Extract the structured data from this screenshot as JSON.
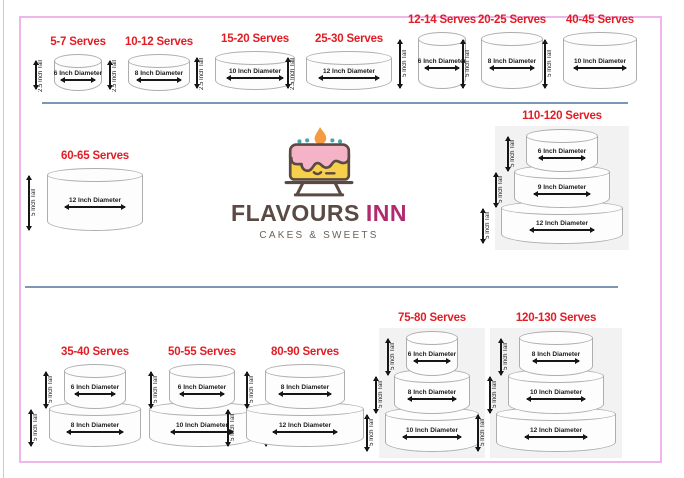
{
  "brand": {
    "name_primary": "FLAVOURS",
    "name_secondary": "INN",
    "tagline": "CAKES & SWEETS"
  },
  "colors": {
    "serves_red": "#e21d24",
    "divider_blue": "#7d96b6",
    "frame_pink": "#eeb7ec",
    "panel_gray": "#f2f2f2",
    "logo_brown": "#5b4a43",
    "logo_magenta": "#b12a6d",
    "icing_pink": "#f4b3c6",
    "cake_yellow": "#f6cf4b",
    "flame_orange": "#f49b42"
  },
  "groups": [
    {
      "serves": "5-7 Serves",
      "tiers": [
        {
          "diameter": "6 Inch Diameter",
          "height": "2.5 Inch Tall"
        }
      ]
    },
    {
      "serves": "10-12 Serves",
      "tiers": [
        {
          "diameter": "8 Inch Diameter",
          "height": "2.5 Inch Tall"
        }
      ]
    },
    {
      "serves": "15-20 Serves",
      "tiers": [
        {
          "diameter": "10 Inch Diameter",
          "height": "2.5 Inch Tall"
        }
      ]
    },
    {
      "serves": "25-30 Serves",
      "tiers": [
        {
          "diameter": "12 Inch Diameter",
          "height": "2.5 Inch Tall"
        }
      ]
    },
    {
      "serves": "12-14 Serves",
      "tiers": [
        {
          "diameter": "6 Inch Diameter",
          "height": "5 Inch Tall"
        }
      ]
    },
    {
      "serves": "20-25 Serves",
      "tiers": [
        {
          "diameter": "8 Inch Diameter",
          "height": "5 Inch Tall"
        }
      ]
    },
    {
      "serves": "40-45 Serves",
      "tiers": [
        {
          "diameter": "10 Inch Diameter",
          "height": "5 Inch Tall"
        }
      ]
    },
    {
      "serves": "60-65 Serves",
      "tiers": [
        {
          "diameter": "12 Inch Diameter",
          "height": "5 Inch Tall"
        }
      ]
    },
    {
      "serves": "110-120 Serves",
      "tiers": [
        {
          "diameter": "6 Inch Diameter",
          "height": "5 Inch Tall"
        },
        {
          "diameter": "9 Inch Diameter",
          "height": "5 Inch Tall"
        },
        {
          "diameter": "12 Inch Diameter",
          "height": "5 Inch Tall"
        }
      ]
    },
    {
      "serves": "35-40 Serves",
      "tiers": [
        {
          "diameter": "6 Inch Diameter",
          "height": "5 Inch Tall"
        },
        {
          "diameter": "8 Inch Diameter",
          "height": "5 Inch Tall"
        }
      ]
    },
    {
      "serves": "50-55 Serves",
      "tiers": [
        {
          "diameter": "6 Inch Diameter",
          "height": "5 Inch Tall"
        },
        {
          "diameter": "10 Inch Diameter",
          "height": "5 Inch Tall"
        }
      ]
    },
    {
      "serves": "80-90 Serves",
      "tiers": [
        {
          "diameter": "8 Inch Diameter",
          "height": "5 Inch Tall"
        },
        {
          "diameter": "12 Inch Diameter",
          "height": "5 Inch Tall"
        }
      ]
    },
    {
      "serves": "75-80 Serves",
      "tiers": [
        {
          "diameter": "6 Inch Diameter",
          "height": "5 Inch Tall"
        },
        {
          "diameter": "8 Inch Diameter",
          "height": "5 Inch Tall"
        },
        {
          "diameter": "10 Inch Diameter",
          "height": "5 Inch Tall"
        }
      ]
    },
    {
      "serves": "120-130 Serves",
      "tiers": [
        {
          "diameter": "8 Inch Diameter",
          "height": "5 Inch Tall"
        },
        {
          "diameter": "10 Inch Diameter",
          "height": "5 Inch Tall"
        },
        {
          "diameter": "12 Inch Diameter",
          "height": "5 Inch Tall"
        }
      ]
    }
  ]
}
